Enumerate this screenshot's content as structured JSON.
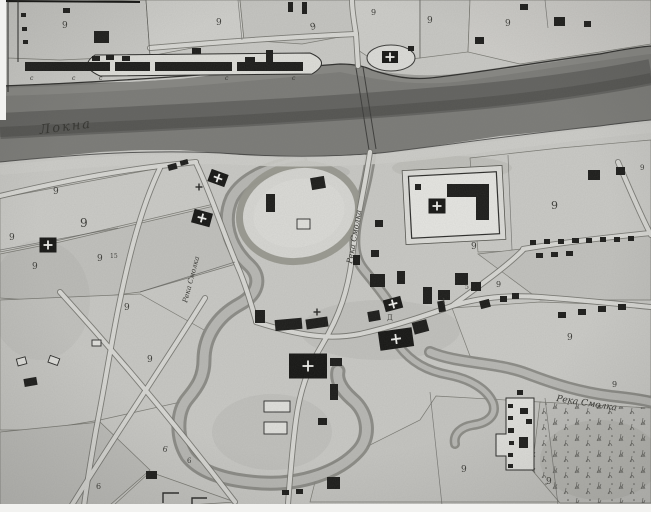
{
  "map": {
    "kind": "historical-town-plan-scan",
    "colors": {
      "paper": "#c9c9c5",
      "river": "#6d6d69",
      "ink": "#1c1c1a"
    },
    "icons": {
      "church_marker": "church-cross-icon",
      "field_mark": "cross-icon"
    },
    "waterway_labels": [
      {
        "text": "Локна",
        "x": 40,
        "y": 134,
        "rotate": -7,
        "size": 13,
        "ls": 2
      },
      {
        "text": "Река Смолка",
        "x": 352,
        "y": 264,
        "rotate": -80,
        "size": 8
      },
      {
        "text": "Река Смолка",
        "x": 187,
        "y": 303,
        "rotate": -75,
        "size": 7
      },
      {
        "text": "Река Смолка",
        "x": 556,
        "y": 401,
        "rotate": 9,
        "size": 9
      }
    ],
    "parcel_labels": [
      {
        "text": "9",
        "x": 62,
        "y": 28,
        "size": 9
      },
      {
        "text": "9",
        "x": 216,
        "y": 25,
        "size": 9
      },
      {
        "text": "9",
        "x": 311,
        "y": 30,
        "size": 9,
        "rotate": -15
      },
      {
        "text": "9",
        "x": 371,
        "y": 15,
        "size": 8
      },
      {
        "text": "9",
        "x": 427,
        "y": 23,
        "size": 9
      },
      {
        "text": "9",
        "x": 505,
        "y": 26,
        "size": 9
      },
      {
        "text": "9",
        "x": 53,
        "y": 194,
        "size": 9
      },
      {
        "text": "9",
        "x": 80,
        "y": 227,
        "size": 12
      },
      {
        "text": "9",
        "x": 97,
        "y": 261,
        "size": 9
      },
      {
        "text": "15",
        "x": 110,
        "y": 258,
        "size": 6
      },
      {
        "text": "9",
        "x": 9,
        "y": 240,
        "size": 9
      },
      {
        "text": "9",
        "x": 32,
        "y": 269,
        "size": 9
      },
      {
        "text": "9",
        "x": 124,
        "y": 310,
        "size": 9
      },
      {
        "text": "9",
        "x": 147,
        "y": 362,
        "size": 9
      },
      {
        "text": "9",
        "x": 471,
        "y": 249,
        "size": 9
      },
      {
        "text": "9",
        "x": 551,
        "y": 209,
        "size": 11
      },
      {
        "text": "9",
        "x": 640,
        "y": 170,
        "size": 7
      },
      {
        "text": "9",
        "x": 496,
        "y": 287,
        "size": 8
      },
      {
        "text": "9",
        "x": 567,
        "y": 340,
        "size": 9
      },
      {
        "text": "9",
        "x": 612,
        "y": 387,
        "size": 8
      },
      {
        "text": "9",
        "x": 461,
        "y": 472,
        "size": 9
      },
      {
        "text": "9",
        "x": 546,
        "y": 484,
        "size": 9
      },
      {
        "text": "6",
        "x": 96,
        "y": 489,
        "size": 8
      },
      {
        "text": "6",
        "x": 162,
        "y": 451,
        "size": 8,
        "rotate": 15
      },
      {
        "text": "6",
        "x": 187,
        "y": 463,
        "size": 7
      },
      {
        "text": "Д",
        "x": 387,
        "y": 320,
        "size": 7
      },
      {
        "text": "5",
        "x": 465,
        "y": 289,
        "size": 6
      },
      {
        "text": "1",
        "x": 442,
        "y": 303,
        "size": 6
      }
    ],
    "wharf_letters": [
      {
        "text": "с",
        "x": 30,
        "y": 80,
        "size": 6
      },
      {
        "text": "с",
        "x": 72,
        "y": 80,
        "size": 6
      },
      {
        "text": "с",
        "x": 99,
        "y": 80,
        "size": 6
      },
      {
        "text": "с",
        "x": 225,
        "y": 80,
        "size": 6
      },
      {
        "text": "с",
        "x": 292,
        "y": 80,
        "size": 6
      }
    ],
    "church_markers": [
      {
        "x": 218,
        "y": 178,
        "w": 18,
        "h": 13,
        "rot": 20
      },
      {
        "x": 202,
        "y": 218,
        "w": 19,
        "h": 14,
        "rot": 15
      },
      {
        "x": 48,
        "y": 245,
        "w": 17,
        "h": 15,
        "rot": 0
      },
      {
        "x": 390,
        "y": 57,
        "w": 16,
        "h": 12,
        "rot": 0
      },
      {
        "x": 437,
        "y": 206,
        "w": 17,
        "h": 15,
        "rot": 0
      },
      {
        "x": 308,
        "y": 366,
        "w": 38,
        "h": 25,
        "rot": 0,
        "cs": 11
      },
      {
        "x": 396,
        "y": 339,
        "w": 34,
        "h": 19,
        "rot": -8,
        "cs": 10
      },
      {
        "x": 393,
        "y": 304,
        "w": 18,
        "h": 12,
        "rot": -15
      }
    ],
    "cross_marks": [
      {
        "x": 199,
        "y": 187
      },
      {
        "x": 317,
        "y": 312
      }
    ]
  }
}
